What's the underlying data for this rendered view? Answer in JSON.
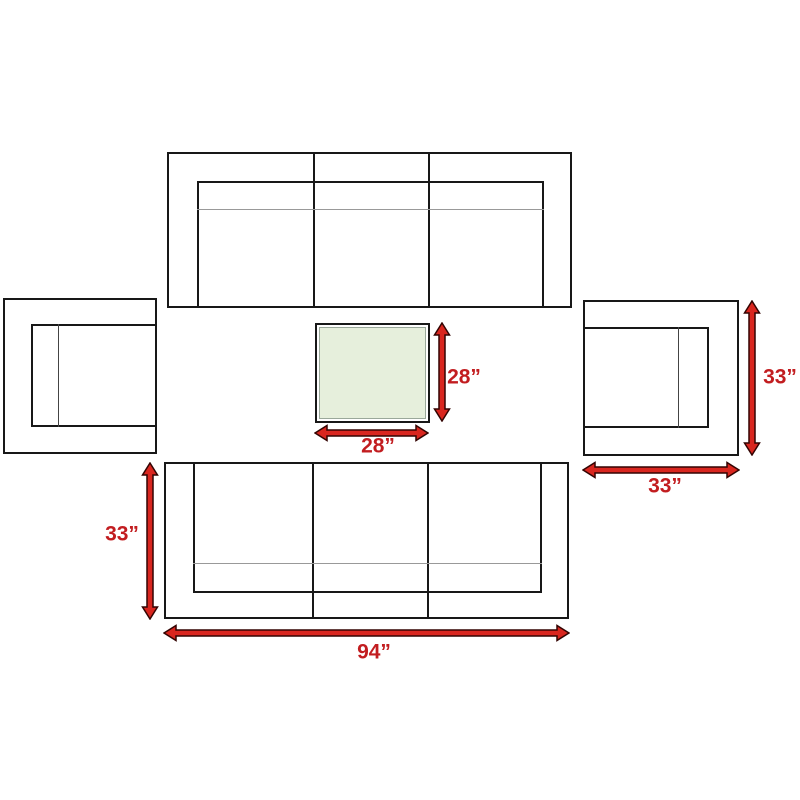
{
  "colors": {
    "arrow_red": "#d9261f",
    "arrow_outline": "#330402",
    "label_red": "#c21d20",
    "line_black": "#181818",
    "thin_line_gray": "#999999",
    "table_fill": "#e6efdc",
    "background": "#ffffff"
  },
  "labels": {
    "table_height": "28”",
    "table_width": "28”",
    "armchair_depth": "33”",
    "armchair_width": "33”",
    "sofa_depth": "33”",
    "sofa_width": "94”"
  }
}
